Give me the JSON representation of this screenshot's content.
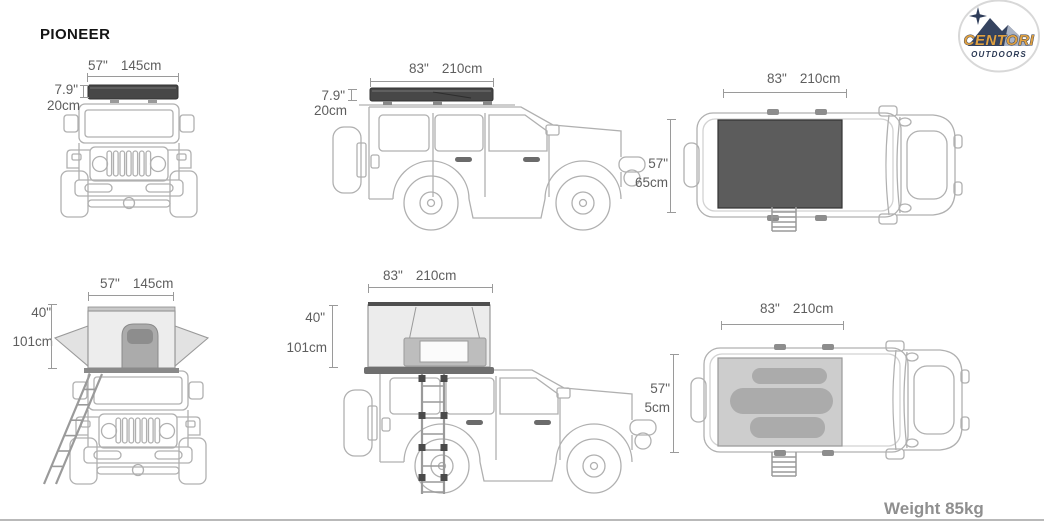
{
  "title": "PIONEER",
  "weight": "Weight 85kg",
  "logo": {
    "brand": "CENTORI",
    "subtitle": "OUTDOORS"
  },
  "views": {
    "front_closed": {
      "width_in": "57\"",
      "width_cm": "145cm",
      "height_in": "7.9\"",
      "height_cm": "20cm"
    },
    "side_closed": {
      "length_in": "83\"",
      "length_cm": "210cm",
      "height_in": "7.9\"",
      "height_cm": "20cm"
    },
    "top_closed": {
      "length_in": "83\"",
      "length_cm": "210cm",
      "width_in": "57\"",
      "width_cm": "65cm"
    },
    "front_open": {
      "width_in": "57\"",
      "width_cm": "145cm",
      "height_in": "40\"",
      "height_cm": "101cm"
    },
    "side_open": {
      "length_in": "83\"",
      "length_cm": "210cm",
      "height_in": "40\"",
      "height_cm": "101cm"
    },
    "top_open": {
      "length_in": "83\"",
      "length_cm": "210cm",
      "width_in": "57\"",
      "width_cm": "5cm"
    }
  },
  "colors": {
    "tent_closed_shell": "#474747",
    "tent_top_view_closed": "#5c5c5c",
    "tent_open_shell": "#ececec",
    "mattress": "#ababab",
    "vehicle_line_art": "#b0b0b0",
    "dimension_text": "#5e5e5e",
    "weight_text": "#8f8f8f",
    "logo_brand_orange": "#dfa041",
    "logo_navy": "#2b3954"
  }
}
